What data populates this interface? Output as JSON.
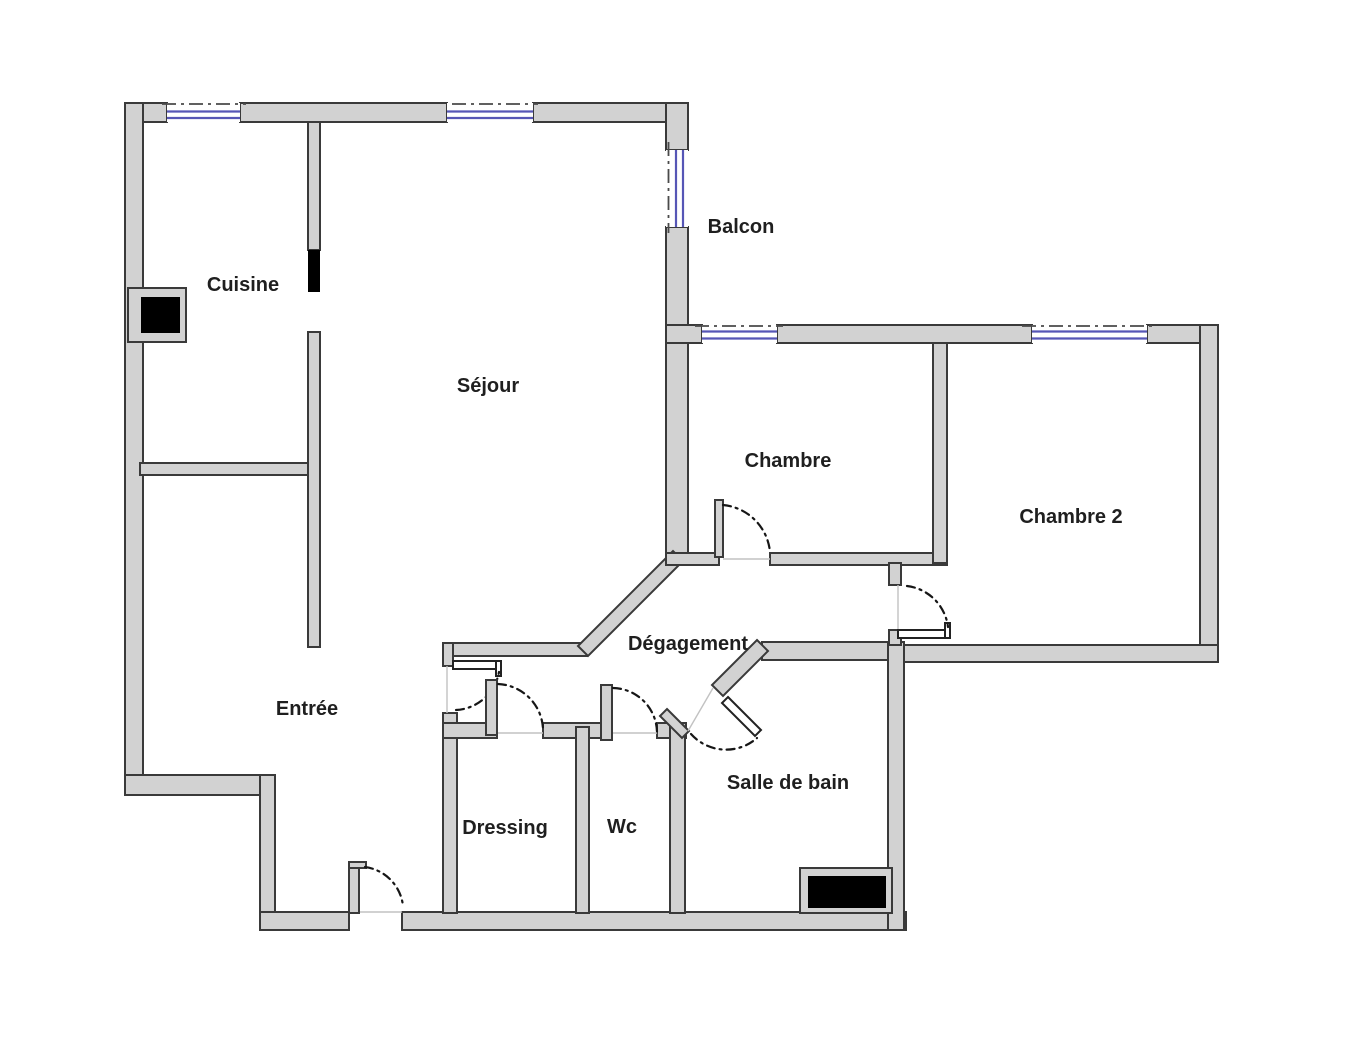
{
  "document": {
    "type": "apartment-floor-plan",
    "background": "#ffffff"
  },
  "rooms": [
    {
      "id": "cuisine",
      "name": "Cuisine"
    },
    {
      "id": "sejour",
      "name": "Séjour"
    },
    {
      "id": "balcon",
      "name": "Balcon"
    },
    {
      "id": "chambre",
      "name": "Chambre"
    },
    {
      "id": "chambre2",
      "name": "Chambre 2"
    },
    {
      "id": "degagement",
      "name": "Dégagement"
    },
    {
      "id": "entree",
      "name": "Entrée"
    },
    {
      "id": "dressing",
      "name": "Dressing"
    },
    {
      "id": "wc",
      "name": "Wc"
    },
    {
      "id": "salle_de_bain",
      "name": "Salle de bain"
    }
  ],
  "colors": {
    "background": "#ffffff",
    "wall_fill": "#d2d2d2",
    "wall_stroke": "#3a3a3a",
    "window_glass": "#5656b6",
    "door_arc": "#161616",
    "shaft_fill": "#000000",
    "opening_line": "#c2c2c2",
    "axis_line": "#4a4a4a",
    "label": "#1f1f1f"
  }
}
